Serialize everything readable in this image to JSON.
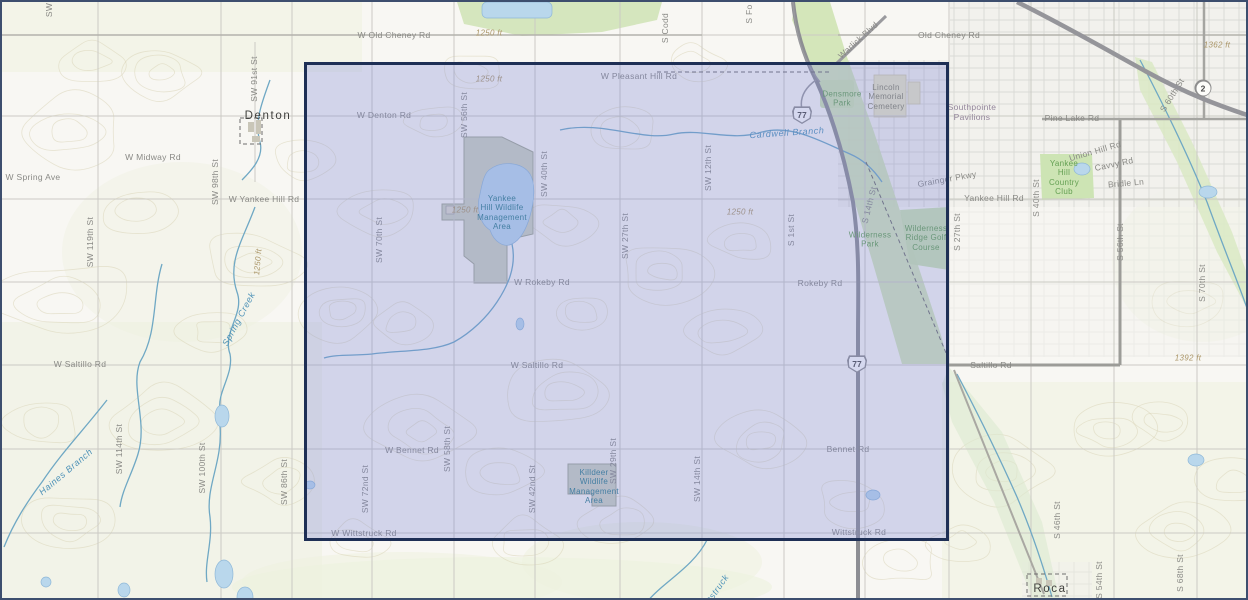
{
  "map": {
    "kind": "topographic-basemap-with-selection",
    "colors": {
      "selection_border": "#1e2f55",
      "selection_fill": "rgba(122,133,216,0.30)",
      "water": "#6fa8c4",
      "park_green": "#cfe3b4",
      "contour": "#d9d3b6",
      "highway_gray": "#8d8e93",
      "background": "#f8f7f3"
    },
    "selection": {
      "left": 302,
      "top": 60,
      "width": 645,
      "height": 479
    },
    "shields": [
      {
        "kind": "us",
        "label": "77",
        "x": 800,
        "y": 113
      },
      {
        "kind": "us",
        "label": "77",
        "x": 855,
        "y": 362
      },
      {
        "kind": "state",
        "label": "2",
        "x": 1201,
        "y": 86
      }
    ],
    "labels": [
      {
        "t": "W Old Cheney Rd",
        "x": 392,
        "y": 33,
        "r": 0,
        "c": "road"
      },
      {
        "t": "1250 ft",
        "x": 487,
        "y": 31,
        "r": 0,
        "c": "elev"
      },
      {
        "t": "1250 ft",
        "x": 487,
        "y": 77,
        "r": 0,
        "c": "elev"
      },
      {
        "t": "S Codd",
        "x": 663,
        "y": 26,
        "r": -90,
        "c": "road"
      },
      {
        "t": "S Fo",
        "x": 747,
        "y": 12,
        "r": -90,
        "c": "road"
      },
      {
        "t": "SW",
        "x": 47,
        "y": 8,
        "r": -90,
        "c": "road"
      },
      {
        "t": "Warlick Blvd",
        "x": 856,
        "y": 38,
        "r": -42,
        "c": "road"
      },
      {
        "t": "Old Cheney Rd",
        "x": 947,
        "y": 33,
        "r": 0,
        "c": "road"
      },
      {
        "t": "1362 ft",
        "x": 1215,
        "y": 43,
        "r": 0,
        "c": "elev"
      },
      {
        "t": "W Pleasant Hill Rd",
        "x": 637,
        "y": 74,
        "r": 0,
        "c": "road"
      },
      {
        "t": "Densmore\nPark",
        "x": 840,
        "y": 97,
        "r": 0,
        "c": "park"
      },
      {
        "t": "Lincoln\nMemorial\nCemetery",
        "x": 884,
        "y": 95,
        "r": 0,
        "c": "cem"
      },
      {
        "t": "Southpointe\nPavilions",
        "x": 970,
        "y": 110,
        "r": 0,
        "c": "urbanp"
      },
      {
        "t": "W Denton Rd",
        "x": 382,
        "y": 113,
        "r": 0,
        "c": "road"
      },
      {
        "t": "Denton",
        "x": 266,
        "y": 115,
        "r": 0,
        "c": "town"
      },
      {
        "t": "SW 91st St",
        "x": 252,
        "y": 77,
        "r": -90,
        "c": "road"
      },
      {
        "t": "SW 56th St",
        "x": 462,
        "y": 113,
        "r": -90,
        "c": "road"
      },
      {
        "t": "Cardwell Branch",
        "x": 785,
        "y": 131,
        "r": -4,
        "c": "water"
      },
      {
        "t": "SW 40th St",
        "x": 542,
        "y": 172,
        "r": -90,
        "c": "road"
      },
      {
        "t": "SW 12th St",
        "x": 706,
        "y": 166,
        "r": -90,
        "c": "road"
      },
      {
        "t": "W Midway Rd",
        "x": 151,
        "y": 155,
        "r": 0,
        "c": "road"
      },
      {
        "t": "W Spring Ave",
        "x": 31,
        "y": 175,
        "r": 0,
        "c": "road"
      },
      {
        "t": "SW 98th St",
        "x": 213,
        "y": 180,
        "r": -90,
        "c": "road"
      },
      {
        "t": "W Yankee Hill Rd",
        "x": 262,
        "y": 197,
        "r": 0,
        "c": "road"
      },
      {
        "t": "Grainger Pkwy",
        "x": 945,
        "y": 177,
        "r": -10,
        "c": "road"
      },
      {
        "t": "Yankee Hill Rd",
        "x": 992,
        "y": 196,
        "r": 0,
        "c": "road"
      },
      {
        "t": "Yankee\nHill\nCountry\nClub",
        "x": 1062,
        "y": 176,
        "r": 0,
        "c": "park"
      },
      {
        "t": "Pine Lake Rd",
        "x": 1070,
        "y": 116,
        "r": 0,
        "c": "road"
      },
      {
        "t": "Union Hill Rd",
        "x": 1093,
        "y": 149,
        "r": -16,
        "c": "road"
      },
      {
        "t": "Cavvy Rd",
        "x": 1112,
        "y": 162,
        "r": -12,
        "c": "road"
      },
      {
        "t": "Bridle Ln",
        "x": 1124,
        "y": 181,
        "r": -5,
        "c": "road"
      },
      {
        "t": "S 60th St",
        "x": 1170,
        "y": 93,
        "r": -58,
        "c": "road"
      },
      {
        "t": "S 40th St",
        "x": 1034,
        "y": 196,
        "r": -90,
        "c": "road"
      },
      {
        "t": "S 27th St",
        "x": 955,
        "y": 230,
        "r": -90,
        "c": "road"
      },
      {
        "t": "S 56th St",
        "x": 1118,
        "y": 240,
        "r": -90,
        "c": "road"
      },
      {
        "t": "S 70th St",
        "x": 1200,
        "y": 281,
        "r": -90,
        "c": "road"
      },
      {
        "t": "Yankee\nHill Wildlife\nManagement\nArea",
        "x": 500,
        "y": 211,
        "r": 0,
        "c": "wma"
      },
      {
        "t": "1250 ft",
        "x": 463,
        "y": 208,
        "r": 0,
        "c": "elev"
      },
      {
        "t": "1250 ft",
        "x": 738,
        "y": 210,
        "r": 0,
        "c": "elev"
      },
      {
        "t": "SW 70th St",
        "x": 377,
        "y": 238,
        "r": -90,
        "c": "road"
      },
      {
        "t": "SW 27th St",
        "x": 623,
        "y": 234,
        "r": -90,
        "c": "road"
      },
      {
        "t": "S 1st St",
        "x": 789,
        "y": 228,
        "r": -90,
        "c": "road"
      },
      {
        "t": "S 14th St",
        "x": 867,
        "y": 203,
        "r": -76,
        "c": "road"
      },
      {
        "t": "Wilderness\nPark",
        "x": 868,
        "y": 238,
        "r": 0,
        "c": "park"
      },
      {
        "t": "Wilderness\nRidge Golf\nCourse",
        "x": 924,
        "y": 236,
        "r": 0,
        "c": "park"
      },
      {
        "t": "SW 119th St",
        "x": 88,
        "y": 240,
        "r": -90,
        "c": "road"
      },
      {
        "t": "1250 ft",
        "x": 256,
        "y": 260,
        "r": -85,
        "c": "elev"
      },
      {
        "t": "W Rokeby Rd",
        "x": 540,
        "y": 280,
        "r": 0,
        "c": "road"
      },
      {
        "t": "Rokeby Rd",
        "x": 818,
        "y": 281,
        "r": 0,
        "c": "road"
      },
      {
        "t": "Spring Creek",
        "x": 237,
        "y": 317,
        "r": -62,
        "c": "water"
      },
      {
        "t": "W Saltillo Rd",
        "x": 78,
        "y": 362,
        "r": 0,
        "c": "road"
      },
      {
        "t": "W Saltillo Rd",
        "x": 535,
        "y": 363,
        "r": 0,
        "c": "road"
      },
      {
        "t": "Saltillo Rd",
        "x": 989,
        "y": 363,
        "r": 0,
        "c": "road"
      },
      {
        "t": "1392 ft",
        "x": 1186,
        "y": 356,
        "r": 0,
        "c": "elev"
      },
      {
        "t": "Haines Branch",
        "x": 64,
        "y": 470,
        "r": -40,
        "c": "water"
      },
      {
        "t": "SW 114th St",
        "x": 117,
        "y": 447,
        "r": -90,
        "c": "road"
      },
      {
        "t": "SW 100th St",
        "x": 200,
        "y": 466,
        "r": -90,
        "c": "road"
      },
      {
        "t": "SW 86th St",
        "x": 282,
        "y": 480,
        "r": -90,
        "c": "road"
      },
      {
        "t": "SW 72nd St",
        "x": 363,
        "y": 487,
        "r": -90,
        "c": "road"
      },
      {
        "t": "SW 58th St",
        "x": 445,
        "y": 447,
        "r": -90,
        "c": "road"
      },
      {
        "t": "W Bennet Rd",
        "x": 410,
        "y": 448,
        "r": 0,
        "c": "road"
      },
      {
        "t": "SW 42nd St",
        "x": 530,
        "y": 487,
        "r": -90,
        "c": "road"
      },
      {
        "t": "SW 29th St",
        "x": 611,
        "y": 459,
        "r": -90,
        "c": "road"
      },
      {
        "t": "SW 14th St",
        "x": 695,
        "y": 477,
        "r": -90,
        "c": "road"
      },
      {
        "t": "Killdeer\nWildlife\nManagement\nArea",
        "x": 592,
        "y": 485,
        "r": 0,
        "c": "wma"
      },
      {
        "t": "Bennet Rd",
        "x": 846,
        "y": 447,
        "r": 0,
        "c": "road"
      },
      {
        "t": "W Wittstruck Rd",
        "x": 362,
        "y": 531,
        "r": 0,
        "c": "road"
      },
      {
        "t": "Wittstruck Rd",
        "x": 857,
        "y": 530,
        "r": 0,
        "c": "road"
      },
      {
        "t": "Wittstruck",
        "x": 712,
        "y": 592,
        "r": -55,
        "c": "water"
      },
      {
        "t": "Roca",
        "x": 1048,
        "y": 588,
        "r": 0,
        "c": "town"
      },
      {
        "t": "S 46th St",
        "x": 1055,
        "y": 518,
        "r": -90,
        "c": "road"
      },
      {
        "t": "S 54th St",
        "x": 1097,
        "y": 578,
        "r": -90,
        "c": "road"
      },
      {
        "t": "S 68th St",
        "x": 1178,
        "y": 571,
        "r": -90,
        "c": "road"
      }
    ]
  }
}
